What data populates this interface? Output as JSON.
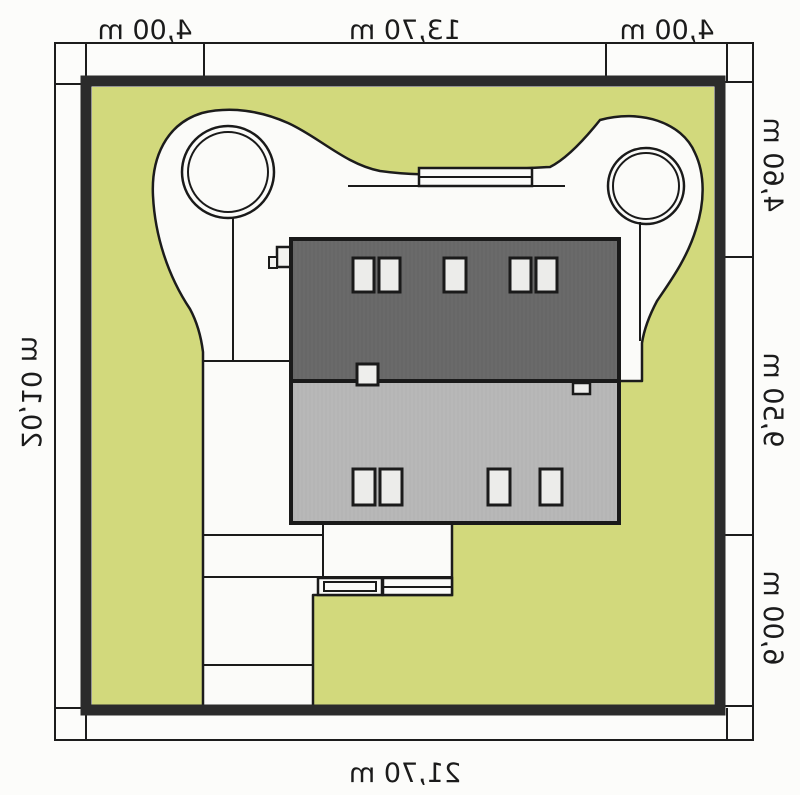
{
  "plan": {
    "type": "house-site-plan",
    "mirrored": true,
    "labels": {
      "top": [
        "4,00 m",
        "13,70 m",
        "4,00 m"
      ],
      "side_right_screen": [
        "4,60 m",
        "9,50 m",
        "6,00 m"
      ],
      "side_left_screen": "20,10 m",
      "bottom": "21,70 m"
    },
    "colors": {
      "lawn_green": "#d2d97c",
      "plot_border": "#2b2b2b",
      "roof_dark": "#6a6a6a",
      "roof_light": "#b8b8b8",
      "paving_white": "#fbfbf9",
      "skylight": "#ececea",
      "line": "#1a1a1a"
    },
    "features": {
      "roof_windows_upper": 5,
      "roof_windows_lower": 4,
      "trees": 2,
      "chimneys": 2
    }
  }
}
